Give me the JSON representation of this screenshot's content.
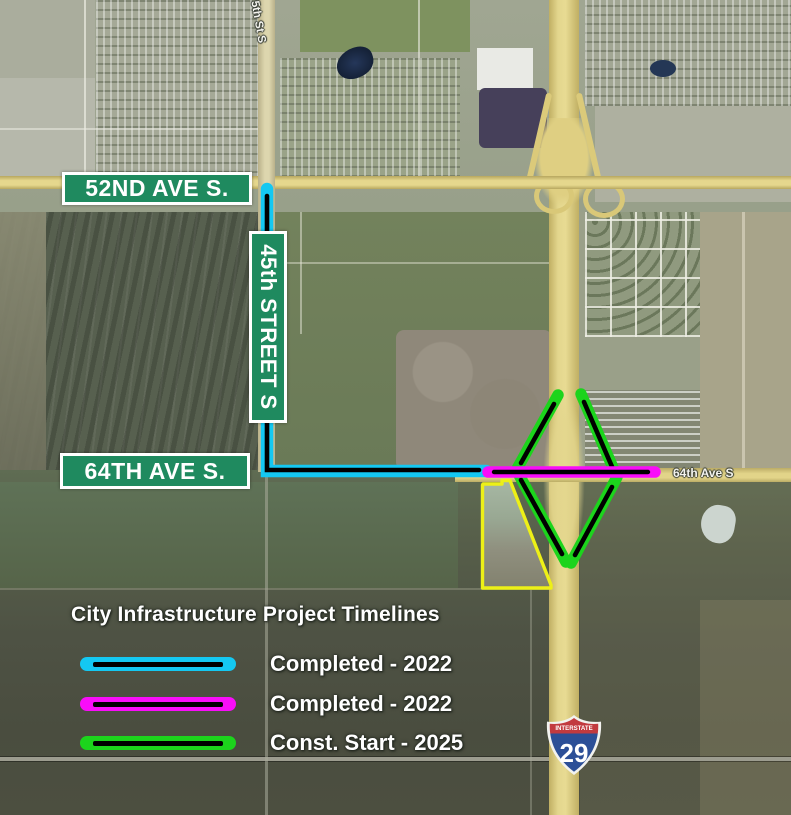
{
  "map": {
    "street_badges": [
      {
        "label": "52ND AVE S."
      },
      {
        "label": "45th STREET S"
      },
      {
        "label": "64TH AVE S."
      }
    ],
    "road_labels": [
      {
        "label": "5th St S"
      },
      {
        "label": "64th Ave S"
      }
    ],
    "interstate_shield": {
      "band": "INTERSTATE",
      "number": "29"
    }
  },
  "legend": {
    "title": "City Infrastructure Project Timelines",
    "items": [
      {
        "label": "Completed - 2022",
        "swatch_color": "#14c8f2"
      },
      {
        "label": "Completed - 2022",
        "swatch_color": "#f90df9"
      },
      {
        "label": "Const. Start - 2025",
        "swatch_color": "#1cd41c"
      }
    ]
  },
  "overlays": {
    "route_45th_64th_color": "#14c8f2",
    "route_64th_ave_color": "#f90df9",
    "interchange_ramps_color": "#1cd41c",
    "parcel_outline_color": "#edf017",
    "badge_green": "#1f8a5f",
    "shield_red": "#c23a3f",
    "shield_blue": "#2c4f97"
  }
}
